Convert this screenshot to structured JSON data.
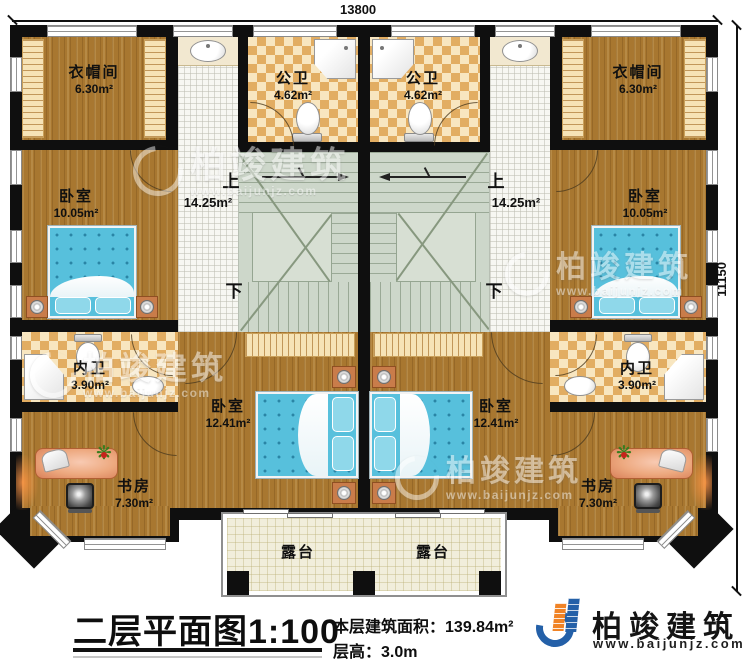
{
  "plan": {
    "dim_top": "13800",
    "dim_right": "11150",
    "units": {
      "left": {
        "cloakroom": {
          "name": "衣帽间",
          "area": "6.30m²"
        },
        "public_bath": {
          "name": "公卫",
          "area": "4.62m²"
        },
        "bedroom_small": {
          "name": "卧室",
          "area": "10.05m²"
        },
        "inner_bath": {
          "name": "内卫",
          "area": "3.90m²"
        },
        "study": {
          "name": "书房",
          "area": "7.30m²"
        },
        "bedroom_large": {
          "name": "卧室",
          "area": "12.41m²"
        },
        "hall": {
          "up": "上",
          "down": "下",
          "area": "14.25m²"
        },
        "terrace": {
          "name": "露台"
        }
      },
      "right": {
        "cloakroom": {
          "name": "衣帽间",
          "area": "6.30m²"
        },
        "public_bath": {
          "name": "公卫",
          "area": "4.62m²"
        },
        "bedroom_small": {
          "name": "卧室",
          "area": "10.05m²"
        },
        "inner_bath": {
          "name": "内卫",
          "area": "3.90m²"
        },
        "study": {
          "name": "书房",
          "area": "7.30m²"
        },
        "bedroom_large": {
          "name": "卧室",
          "area": "12.41m²"
        },
        "hall": {
          "up": "上",
          "down": "下",
          "area": "14.25m²"
        },
        "terrace": {
          "name": "露台"
        }
      }
    }
  },
  "caption": {
    "title": "二层平面图",
    "scale": "1:100",
    "area_label": "本层建筑面积：",
    "area_value": "139.84m²",
    "height_label": "层高：",
    "height_value": "3.0m"
  },
  "brand": {
    "name": "柏竣建筑",
    "website": "www.baijunjz.com"
  },
  "watermark": {
    "name": "柏竣建筑",
    "website": "www.baijunjz.com"
  },
  "colors": {
    "wall": "#0f0f0f",
    "wood": "#a87730",
    "tile_dark": "#e2ad62",
    "tile_light": "#f8e6c0",
    "stair": "#cdd7ca",
    "terrace": "#f1eedb",
    "bed": "#57c0dc",
    "brand_blue": "#2460a8",
    "brand_orange": "#f08326"
  }
}
